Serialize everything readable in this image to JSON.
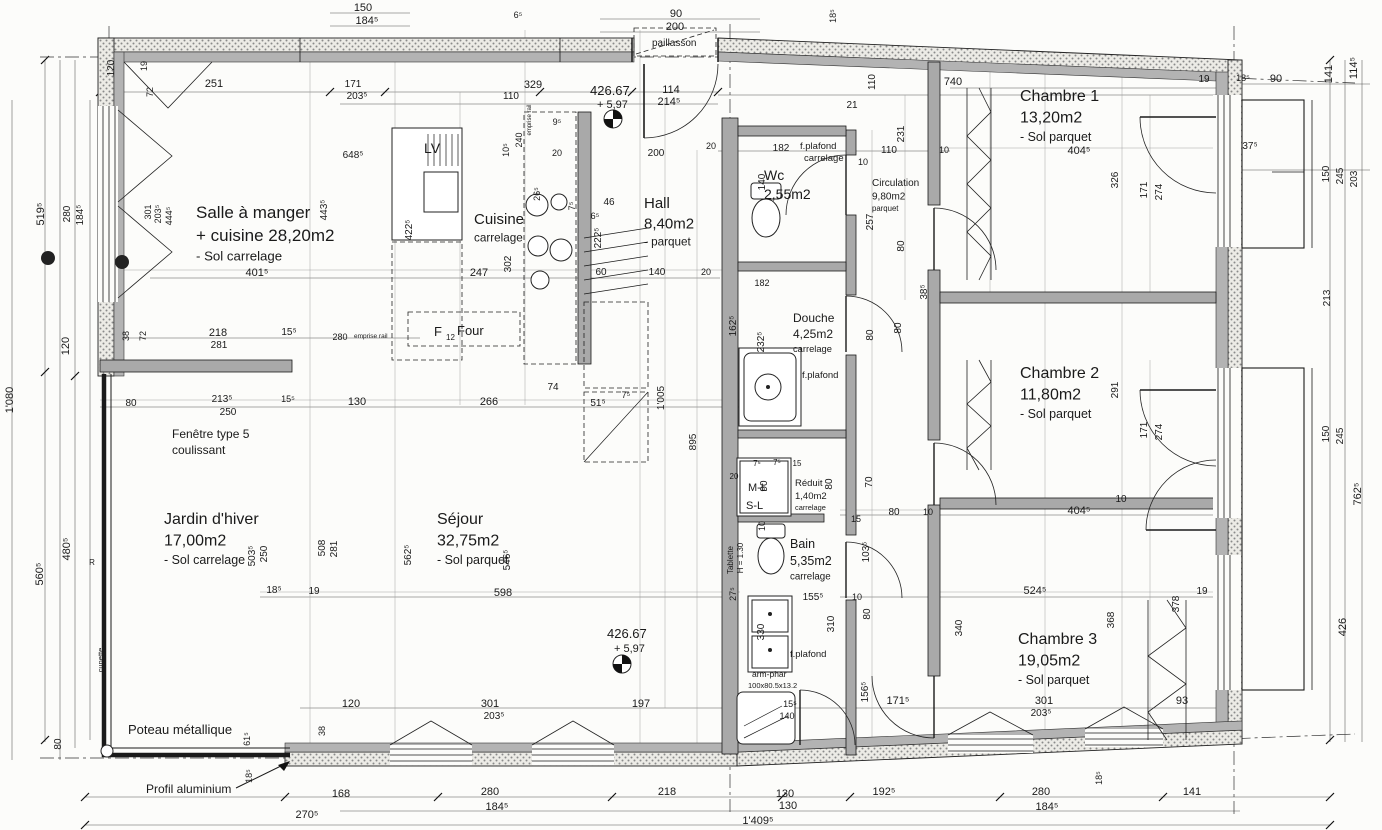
{
  "drawing": {
    "type": "floor-plan",
    "language": "fr",
    "units": "cm",
    "colors": {
      "line": "#1a1a1a",
      "wall_gray": "#a9a9a9",
      "stipple": "#8a8a8a",
      "paper": "#fcfcfa"
    }
  },
  "rooms": [
    {
      "name": "Salle à manger",
      "area": "+ cuisine 28,20m2",
      "floor": "- Sol carrelage",
      "x": 196,
      "y": 218,
      "s": 17
    },
    {
      "name": "Cuisine",
      "area": null,
      "floor": "carrelage",
      "x": 474,
      "y": 224,
      "s": 15
    },
    {
      "name": "Hall",
      "area": "8,40m2",
      "floor": "- parquet",
      "x": 644,
      "y": 208,
      "s": 15
    },
    {
      "name": "Wc",
      "area": "2,55m2",
      "floor": null,
      "x": 764,
      "y": 180,
      "s": 14
    },
    {
      "name": "Douche",
      "area": "4,25m2",
      "floor": "carrelage",
      "x": 793,
      "y": 322,
      "s": 12
    },
    {
      "name": "Réduit",
      "area": "1,40m2",
      "floor": "carrelage",
      "x": 795,
      "y": 486,
      "s": 9.5
    },
    {
      "name": "Bain",
      "area": "5,35m2",
      "floor": "carrelage",
      "x": 790,
      "y": 548,
      "s": 12.5
    },
    {
      "name": "Circulation",
      "area": "9,80m2",
      "floor": "parquet",
      "x": 872,
      "y": 186,
      "s": 10
    },
    {
      "name": "Chambre 1",
      "area": "13,20m2",
      "floor": "- Sol parquet",
      "x": 1020,
      "y": 101,
      "s": 16
    },
    {
      "name": "Chambre 2",
      "area": "11,80m2",
      "floor": "- Sol parquet",
      "x": 1020,
      "y": 378,
      "s": 16
    },
    {
      "name": "Chambre 3",
      "area": "19,05m2",
      "floor": "- Sol parquet",
      "x": 1018,
      "y": 644,
      "s": 16
    },
    {
      "name": "Jardin d'hiver",
      "area": "17,00m2",
      "floor": "- Sol carrelage",
      "x": 164,
      "y": 524,
      "s": 16
    },
    {
      "name": "Séjour",
      "area": "32,75m2",
      "floor": "- Sol parquet",
      "x": 437,
      "y": 524,
      "s": 16
    }
  ],
  "annotations": [
    {
      "t": "Fenêtre type 5",
      "x": 172,
      "y": 438,
      "s": 12,
      "n": "annotation-fenetre-type"
    },
    {
      "t": "coulissant",
      "x": 172,
      "y": 454,
      "s": 12,
      "n": "annotation-fenetre-type"
    },
    {
      "t": "Poteau métallique",
      "x": 128,
      "y": 734,
      "s": 13,
      "n": "annotation-poteau-metallique"
    },
    {
      "t": "Profil aluminium",
      "x": 146,
      "y": 793,
      "s": 12,
      "n": "annotation-profil-aluminium"
    },
    {
      "t": "paillasson",
      "x": 652,
      "y": 46,
      "s": 10,
      "n": "annotation-paillasson"
    },
    {
      "t": "LV",
      "x": 424,
      "y": 153,
      "s": 14,
      "n": "label-lave-vaisselle"
    },
    {
      "t": "F",
      "x": 434,
      "y": 336,
      "s": 13,
      "n": "label-frigo"
    },
    {
      "t": "12",
      "x": 446,
      "y": 340,
      "s": 8,
      "n": "label-frigo"
    },
    {
      "t": "Four",
      "x": 457,
      "y": 335,
      "s": 13,
      "n": "label-four"
    },
    {
      "t": "M-L",
      "x": 748,
      "y": 491,
      "s": 11,
      "n": "label-machine-a-laver"
    },
    {
      "t": "S-L",
      "x": 746,
      "y": 509,
      "s": 11,
      "n": "label-seche-linge"
    },
    {
      "t": "f.plafond",
      "x": 800,
      "y": 149,
      "s": 9.5,
      "n": "annotation-faux-plafond"
    },
    {
      "t": "carrelage",
      "x": 804,
      "y": 161,
      "s": 9.5,
      "n": "annotation-faux-plafond"
    },
    {
      "t": "f.plafond",
      "x": 802,
      "y": 378,
      "s": 9.5,
      "n": "annotation-faux-plafond"
    },
    {
      "t": "f.plafond",
      "x": 790,
      "y": 657,
      "s": 9.5,
      "n": "annotation-faux-plafond"
    },
    {
      "t": "arm-phar",
      "x": 752,
      "y": 677,
      "s": 8.5,
      "n": "annotation-armoire-pharmacie"
    },
    {
      "t": "100x80.5x13.2",
      "x": 748,
      "y": 688,
      "s": 7.5,
      "n": "annotation-armoire-pharmacie"
    },
    {
      "t": "Tablette",
      "x": 733,
      "y": 560,
      "r": -90,
      "s": 8,
      "n": "annotation-tablette"
    },
    {
      "t": "H = 1.30",
      "x": 743,
      "y": 558,
      "r": -90,
      "s": 8,
      "n": "annotation-tablette"
    },
    {
      "t": "cunette",
      "x": 103,
      "y": 660,
      "r": -90,
      "s": 7.5,
      "n": "annotation-cunette"
    },
    {
      "t": "emprise rail",
      "x": 354,
      "y": 338,
      "s": 6.5,
      "n": "annotation-emprise-rail"
    },
    {
      "t": "emprise rail",
      "x": 531,
      "y": 120,
      "r": -90,
      "s": 6,
      "n": "annotation-emprise-rail"
    },
    {
      "t": "426.67",
      "x": 590,
      "y": 95,
      "s": 13,
      "n": "level-mark-value"
    },
    {
      "t": "+ 5,97",
      "x": 597,
      "y": 108,
      "s": 11,
      "n": "level-mark-value"
    },
    {
      "t": "426.67",
      "x": 607,
      "y": 638,
      "s": 13,
      "n": "level-mark-value"
    },
    {
      "t": "+ 5,97",
      "x": 614,
      "y": 652,
      "s": 11,
      "n": "level-mark-value"
    }
  ],
  "dimensions": [
    {
      "t": "150",
      "x": 363,
      "y": 11
    },
    {
      "t": "184⁵",
      "x": 367,
      "y": 24
    },
    {
      "t": "6⁵",
      "x": 518,
      "y": 18,
      "s": 9
    },
    {
      "t": "90",
      "x": 676,
      "y": 17
    },
    {
      "t": "200",
      "x": 675,
      "y": 30
    },
    {
      "t": "18⁵",
      "x": 836,
      "y": 16,
      "r": -90,
      "s": 9
    },
    {
      "t": "120",
      "x": 114,
      "y": 68,
      "r": -90,
      "s": 10
    },
    {
      "t": "19",
      "x": 147,
      "y": 66,
      "r": -90,
      "s": 9
    },
    {
      "t": "72",
      "x": 153,
      "y": 92,
      "r": -90,
      "s": 9
    },
    {
      "t": "251",
      "x": 214,
      "y": 87
    },
    {
      "t": "171",
      "x": 353,
      "y": 87,
      "s": 10
    },
    {
      "t": "203⁵",
      "x": 357,
      "y": 99,
      "s": 10
    },
    {
      "t": "329",
      "x": 533,
      "y": 88
    },
    {
      "t": "110",
      "x": 511,
      "y": 99,
      "s": 10
    },
    {
      "t": "9⁵",
      "x": 557,
      "y": 125,
      "s": 9
    },
    {
      "t": "114",
      "x": 671,
      "y": 93
    },
    {
      "t": "214⁵",
      "x": 669,
      "y": 105
    },
    {
      "t": "200",
      "x": 656,
      "y": 156,
      "s": 10
    },
    {
      "t": "20",
      "x": 711,
      "y": 149,
      "s": 9
    },
    {
      "t": "21",
      "x": 852,
      "y": 108,
      "s": 10
    },
    {
      "t": "110",
      "x": 875,
      "y": 82,
      "r": -90,
      "s": 10
    },
    {
      "t": "740",
      "x": 953,
      "y": 85
    },
    {
      "t": "231",
      "x": 904,
      "y": 134,
      "r": -90,
      "s": 10
    },
    {
      "t": "182",
      "x": 781,
      "y": 151,
      "s": 10
    },
    {
      "t": "140",
      "x": 765,
      "y": 182,
      "r": -90,
      "s": 10
    },
    {
      "t": "110",
      "x": 889,
      "y": 153,
      "s": 10
    },
    {
      "t": "10",
      "x": 944,
      "y": 153,
      "s": 9
    },
    {
      "t": "10",
      "x": 863,
      "y": 165,
      "s": 9
    },
    {
      "t": "257",
      "x": 873,
      "y": 222,
      "r": -90,
      "s": 10
    },
    {
      "t": "80",
      "x": 904,
      "y": 246,
      "r": -90,
      "s": 10
    },
    {
      "t": "19",
      "x": 1204,
      "y": 82,
      "s": 10
    },
    {
      "t": "18⁵",
      "x": 1243,
      "y": 81,
      "s": 9
    },
    {
      "t": "90",
      "x": 1276,
      "y": 82
    },
    {
      "t": "141",
      "x": 1332,
      "y": 74,
      "r": -90
    },
    {
      "t": "114⁵",
      "x": 1357,
      "y": 68,
      "r": -90
    },
    {
      "t": "37⁵",
      "x": 1250,
      "y": 149,
      "s": 10
    },
    {
      "t": "404⁵",
      "x": 1079,
      "y": 154
    },
    {
      "t": "326",
      "x": 1118,
      "y": 180,
      "r": -90,
      "s": 10
    },
    {
      "t": "171",
      "x": 1147,
      "y": 190,
      "r": -90,
      "s": 10
    },
    {
      "t": "274",
      "x": 1162,
      "y": 192,
      "r": -90,
      "s": 10
    },
    {
      "t": "150",
      "x": 1329,
      "y": 174,
      "r": -90,
      "s": 10
    },
    {
      "t": "245",
      "x": 1343,
      "y": 176,
      "r": -90,
      "s": 10
    },
    {
      "t": "203",
      "x": 1357,
      "y": 179,
      "r": -90,
      "s": 10
    },
    {
      "t": "519⁵",
      "x": 44,
      "y": 214,
      "r": -90
    },
    {
      "t": "280",
      "x": 70,
      "y": 214,
      "r": -90,
      "s": 10
    },
    {
      "t": "184⁵",
      "x": 83,
      "y": 215,
      "r": -90,
      "s": 10
    },
    {
      "t": "301",
      "x": 151,
      "y": 212,
      "r": -90,
      "s": 9
    },
    {
      "t": "203⁵",
      "x": 161,
      "y": 214,
      "r": -90,
      "s": 9
    },
    {
      "t": "444⁵",
      "x": 172,
      "y": 216,
      "r": -90,
      "s": 9
    },
    {
      "t": "443⁵",
      "x": 327,
      "y": 210,
      "r": -90,
      "s": 10
    },
    {
      "t": "648⁵",
      "x": 353,
      "y": 158,
      "s": 10
    },
    {
      "t": "422⁵",
      "x": 412,
      "y": 230,
      "r": -90,
      "s": 10
    },
    {
      "t": "10⁵",
      "x": 509,
      "y": 150,
      "r": -90,
      "s": 9
    },
    {
      "t": "240",
      "x": 522,
      "y": 140,
      "r": -90,
      "s": 9
    },
    {
      "t": "20",
      "x": 557,
      "y": 156,
      "s": 9
    },
    {
      "t": "26⁵",
      "x": 540,
      "y": 194,
      "r": -90,
      "s": 9
    },
    {
      "t": "7⁵",
      "x": 575,
      "y": 206,
      "r": -90,
      "s": 9
    },
    {
      "t": "46",
      "x": 609,
      "y": 205,
      "s": 10
    },
    {
      "t": "6⁵",
      "x": 595,
      "y": 219,
      "s": 9
    },
    {
      "t": "222⁵",
      "x": 601,
      "y": 238,
      "r": -90,
      "s": 10
    },
    {
      "t": "401⁵",
      "x": 257,
      "y": 276
    },
    {
      "t": "247",
      "x": 479,
      "y": 276
    },
    {
      "t": "302",
      "x": 511,
      "y": 264,
      "r": -90,
      "s": 10
    },
    {
      "t": "60",
      "x": 601,
      "y": 275,
      "s": 10
    },
    {
      "t": "140",
      "x": 657,
      "y": 275,
      "s": 10
    },
    {
      "t": "20",
      "x": 706,
      "y": 275,
      "s": 9
    },
    {
      "t": "182",
      "x": 762,
      "y": 286,
      "s": 9
    },
    {
      "t": "213",
      "x": 1330,
      "y": 298,
      "r": -90,
      "s": 10
    },
    {
      "t": "38⁵",
      "x": 927,
      "y": 292,
      "r": -90,
      "s": 10
    },
    {
      "t": "218",
      "x": 218,
      "y": 336
    },
    {
      "t": "281",
      "x": 219,
      "y": 348,
      "s": 10
    },
    {
      "t": "15⁵",
      "x": 289,
      "y": 335,
      "s": 10
    },
    {
      "t": "280",
      "x": 340,
      "y": 340,
      "s": 9
    },
    {
      "t": "38",
      "x": 129,
      "y": 336,
      "r": -90,
      "s": 9
    },
    {
      "t": "72",
      "x": 146,
      "y": 336,
      "r": -90,
      "s": 9
    },
    {
      "t": "162⁵",
      "x": 736,
      "y": 326,
      "r": -90,
      "s": 10
    },
    {
      "t": "232⁵",
      "x": 764,
      "y": 342,
      "r": -90,
      "s": 10
    },
    {
      "t": "80",
      "x": 873,
      "y": 335,
      "r": -90,
      "s": 10
    },
    {
      "t": "80",
      "x": 901,
      "y": 328,
      "r": -90,
      "s": 10
    },
    {
      "t": "80",
      "x": 131,
      "y": 406,
      "s": 10
    },
    {
      "t": "213⁵",
      "x": 222,
      "y": 402,
      "s": 10
    },
    {
      "t": "250",
      "x": 228,
      "y": 415,
      "s": 10
    },
    {
      "t": "15⁵",
      "x": 288,
      "y": 402,
      "s": 9
    },
    {
      "t": "130",
      "x": 357,
      "y": 405
    },
    {
      "t": "266",
      "x": 489,
      "y": 405
    },
    {
      "t": "74",
      "x": 553,
      "y": 390,
      "s": 10
    },
    {
      "t": "51⁵",
      "x": 598,
      "y": 406,
      "s": 10
    },
    {
      "t": "7⁵",
      "x": 626,
      "y": 398,
      "s": 9
    },
    {
      "t": "1'005",
      "x": 664,
      "y": 398,
      "r": -90,
      "s": 10
    },
    {
      "t": "895",
      "x": 696,
      "y": 442,
      "r": -90,
      "s": 10
    },
    {
      "t": "291",
      "x": 1118,
      "y": 390,
      "r": -90,
      "s": 10
    },
    {
      "t": "171",
      "x": 1147,
      "y": 430,
      "r": -90,
      "s": 10
    },
    {
      "t": "274",
      "x": 1162,
      "y": 432,
      "r": -90,
      "s": 10
    },
    {
      "t": "150",
      "x": 1329,
      "y": 434,
      "r": -90,
      "s": 10
    },
    {
      "t": "245",
      "x": 1343,
      "y": 436,
      "r": -90,
      "s": 10
    },
    {
      "t": "503⁵",
      "x": 255,
      "y": 556,
      "r": -90,
      "s": 10
    },
    {
      "t": "250",
      "x": 267,
      "y": 554,
      "r": -90,
      "s": 10
    },
    {
      "t": "508",
      "x": 325,
      "y": 548,
      "r": -90,
      "s": 10
    },
    {
      "t": "281",
      "x": 337,
      "y": 549,
      "r": -90,
      "s": 10
    },
    {
      "t": "562⁵",
      "x": 411,
      "y": 555,
      "r": -90,
      "s": 10
    },
    {
      "t": "546⁵",
      "x": 510,
      "y": 560,
      "r": -90,
      "s": 10
    },
    {
      "t": "1'080",
      "x": 13,
      "y": 400,
      "r": -90
    },
    {
      "t": "120",
      "x": 69,
      "y": 346,
      "r": -90
    },
    {
      "t": "480⁵",
      "x": 70,
      "y": 549,
      "r": -90
    },
    {
      "t": "560⁵",
      "x": 43,
      "y": 574,
      "r": -90
    },
    {
      "t": "R",
      "x": 92,
      "y": 565,
      "s": 8
    },
    {
      "t": "90",
      "x": 767,
      "y": 486,
      "r": -90,
      "s": 10
    },
    {
      "t": "10",
      "x": 765,
      "y": 526,
      "r": -90,
      "s": 9
    },
    {
      "t": "7⁵",
      "x": 757,
      "y": 466,
      "s": 8
    },
    {
      "t": "7⁵",
      "x": 777,
      "y": 465,
      "s": 8
    },
    {
      "t": "15",
      "x": 797,
      "y": 466,
      "s": 8
    },
    {
      "t": "20",
      "x": 734,
      "y": 479,
      "s": 8
    },
    {
      "t": "80",
      "x": 832,
      "y": 484,
      "r": -90,
      "s": 10
    },
    {
      "t": "70",
      "x": 872,
      "y": 482,
      "r": -90,
      "s": 10
    },
    {
      "t": "15",
      "x": 856,
      "y": 522,
      "s": 9
    },
    {
      "t": "80",
      "x": 894,
      "y": 515,
      "s": 10
    },
    {
      "t": "10",
      "x": 928,
      "y": 515,
      "s": 9
    },
    {
      "t": "103⁵",
      "x": 869,
      "y": 552,
      "r": -90,
      "s": 10
    },
    {
      "t": "404⁵",
      "x": 1079,
      "y": 514
    },
    {
      "t": "10",
      "x": 1121,
      "y": 502,
      "s": 10
    },
    {
      "t": "18⁵",
      "x": 274,
      "y": 593,
      "s": 10
    },
    {
      "t": "19",
      "x": 314,
      "y": 594,
      "s": 10
    },
    {
      "t": "598",
      "x": 503,
      "y": 596
    },
    {
      "t": "27⁵",
      "x": 736,
      "y": 594,
      "r": -90,
      "s": 9
    },
    {
      "t": "155⁵",
      "x": 813,
      "y": 600,
      "s": 10
    },
    {
      "t": "10",
      "x": 857,
      "y": 600,
      "s": 9
    },
    {
      "t": "310",
      "x": 834,
      "y": 624,
      "r": -90,
      "s": 10
    },
    {
      "t": "80",
      "x": 870,
      "y": 614,
      "r": -90,
      "s": 10
    },
    {
      "t": "330",
      "x": 764,
      "y": 632,
      "r": -90,
      "s": 10
    },
    {
      "t": "156⁵",
      "x": 868,
      "y": 692,
      "r": -90,
      "s": 10
    },
    {
      "t": "524⁵",
      "x": 1035,
      "y": 594
    },
    {
      "t": "19",
      "x": 1202,
      "y": 594,
      "s": 10
    },
    {
      "t": "378",
      "x": 1179,
      "y": 604,
      "r": -90,
      "s": 10
    },
    {
      "t": "368",
      "x": 1114,
      "y": 620,
      "r": -90,
      "s": 10
    },
    {
      "t": "426",
      "x": 1346,
      "y": 627,
      "r": -90
    },
    {
      "t": "762⁵",
      "x": 1361,
      "y": 494,
      "r": -90
    },
    {
      "t": "340",
      "x": 962,
      "y": 628,
      "r": -90,
      "s": 10
    },
    {
      "t": "15⁵",
      "x": 790,
      "y": 707,
      "s": 9
    },
    {
      "t": "140",
      "x": 787,
      "y": 719,
      "s": 9
    },
    {
      "t": "120",
      "x": 351,
      "y": 707
    },
    {
      "t": "301",
      "x": 490,
      "y": 707
    },
    {
      "t": "203⁵",
      "x": 494,
      "y": 719,
      "s": 10
    },
    {
      "t": "197",
      "x": 641,
      "y": 707
    },
    {
      "t": "171⁵",
      "x": 898,
      "y": 704
    },
    {
      "t": "301",
      "x": 1044,
      "y": 704
    },
    {
      "t": "203⁵",
      "x": 1041,
      "y": 716,
      "s": 10
    },
    {
      "t": "93",
      "x": 1182,
      "y": 704
    },
    {
      "t": "38",
      "x": 325,
      "y": 731,
      "r": -90,
      "s": 9
    },
    {
      "t": "61⁵",
      "x": 250,
      "y": 739,
      "r": -90,
      "s": 9
    },
    {
      "t": "80",
      "x": 61,
      "y": 744,
      "r": -90,
      "s": 10
    },
    {
      "t": "18⁵",
      "x": 252,
      "y": 776,
      "r": -90,
      "s": 9
    },
    {
      "t": "270⁵",
      "x": 307,
      "y": 818
    },
    {
      "t": "168",
      "x": 341,
      "y": 797
    },
    {
      "t": "280",
      "x": 490,
      "y": 795
    },
    {
      "t": "184⁵",
      "x": 497,
      "y": 810
    },
    {
      "t": "218",
      "x": 667,
      "y": 795
    },
    {
      "t": "130",
      "x": 785,
      "y": 797
    },
    {
      "t": "130",
      "x": 788,
      "y": 809
    },
    {
      "t": "1'409⁵",
      "x": 758,
      "y": 824
    },
    {
      "t": "192⁵",
      "x": 884,
      "y": 795
    },
    {
      "t": "280",
      "x": 1041,
      "y": 795
    },
    {
      "t": "184⁵",
      "x": 1047,
      "y": 810
    },
    {
      "t": "141",
      "x": 1192,
      "y": 795
    },
    {
      "t": "18⁵",
      "x": 1102,
      "y": 778,
      "r": -90,
      "s": 9
    }
  ]
}
